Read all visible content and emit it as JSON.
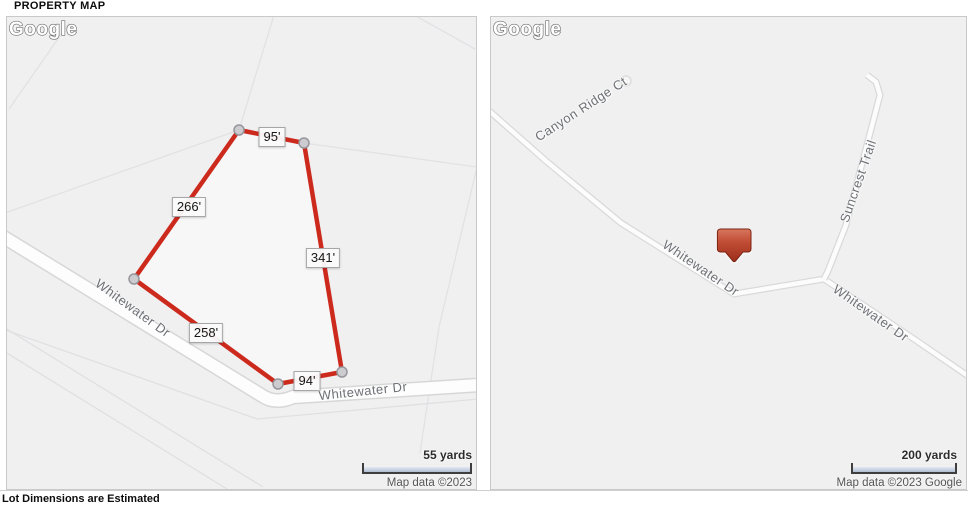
{
  "page": {
    "title": "PROPERTY MAP",
    "disclaimer": "Lot Dimensions are Estimated"
  },
  "left_map": {
    "lot_dimensions": [
      "95'",
      "266'",
      "341'",
      "258'",
      "94'"
    ],
    "street_labels": [
      "Whitewater Dr",
      "Whitewater Dr"
    ],
    "scale_label": "55 yards",
    "attribution": "Map data ©2023",
    "logo": "Google"
  },
  "right_map": {
    "street_labels": [
      "Canyon Ridge Ct",
      "Suncrest Trail",
      "Whitewater Dr",
      "Whitewater Dr"
    ],
    "scale_label": "200 yards",
    "attribution": "Map data ©2023 Google",
    "logo": "Google",
    "marker": "property-location"
  },
  "colors": {
    "lot_outline": "#cd2a1e",
    "marker": "#b5432e",
    "scale_bar": "#c6d1e2",
    "map_background": "#f0f0f1"
  }
}
